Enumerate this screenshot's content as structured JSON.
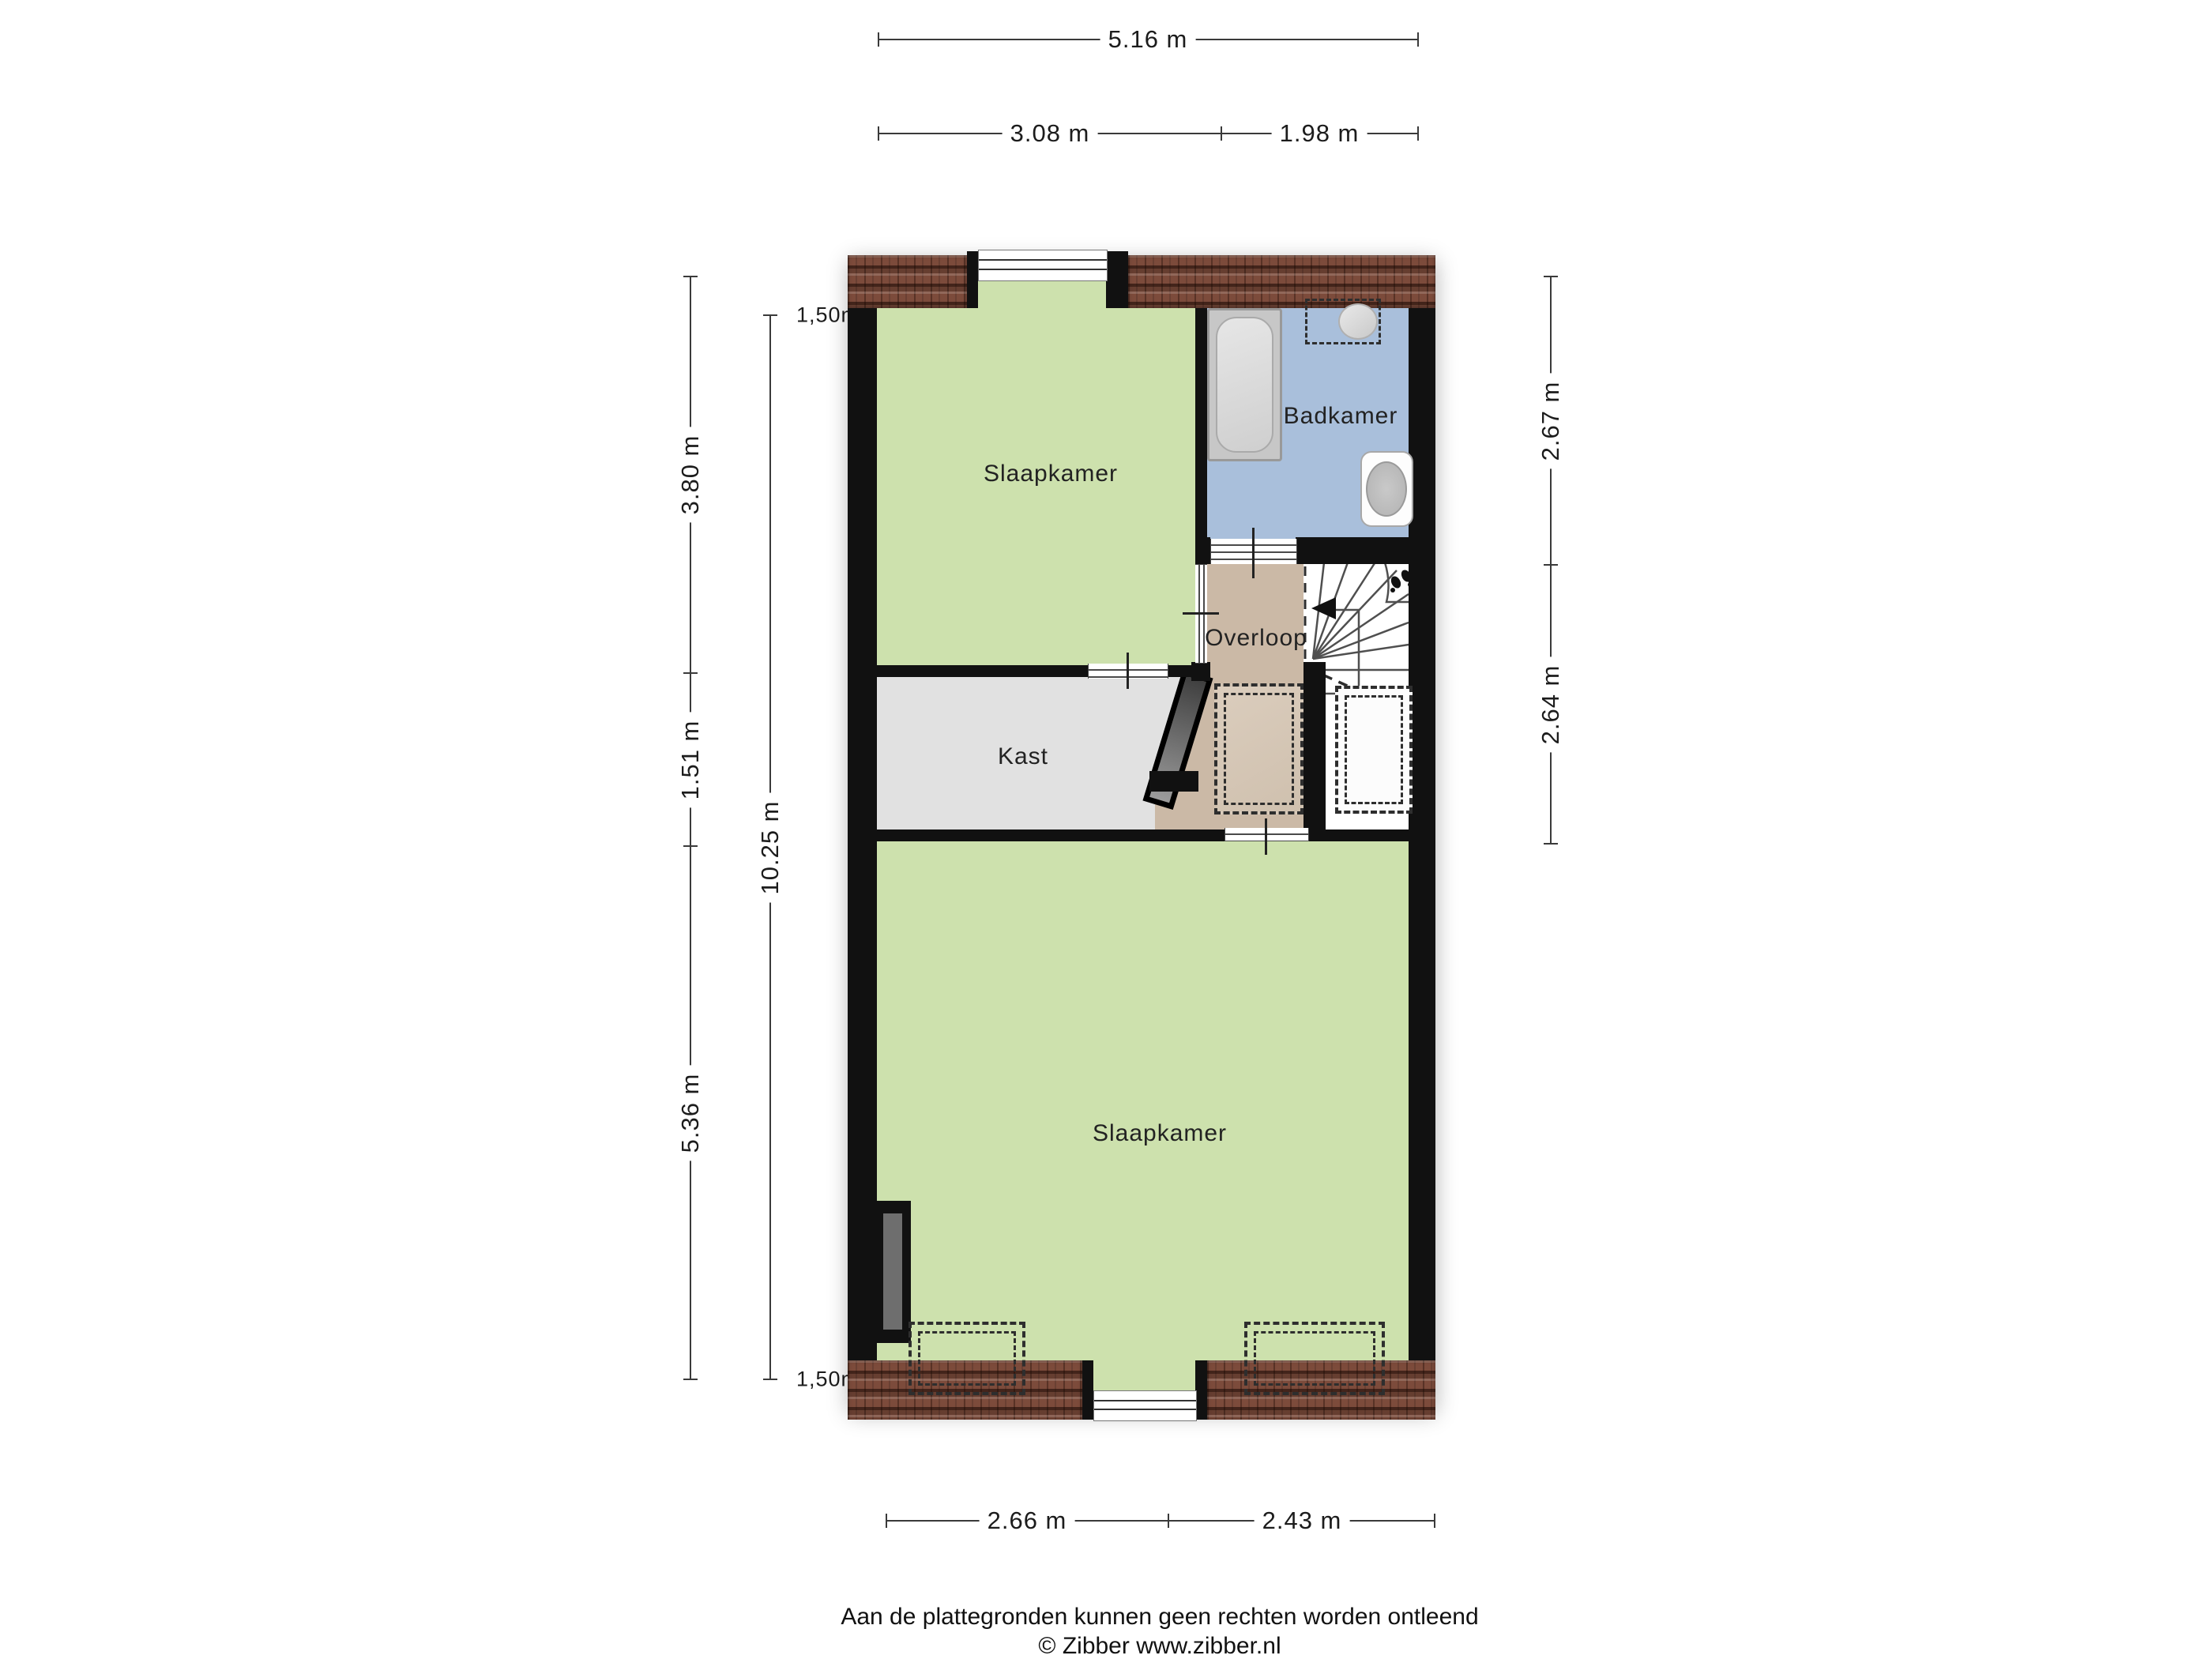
{
  "rooms": {
    "bedroom_top": "Slaapkamer",
    "bathroom": "Badkamer",
    "landing": "Overloop",
    "closet": "Kast",
    "bedroom_bottom": "Slaapkamer"
  },
  "dimensions": {
    "top_total": "5.16 m",
    "top_left": "3.08 m",
    "top_right": "1.98 m",
    "left_outer_top": "3.80 m",
    "left_outer_mid": "1.51 m",
    "left_outer_bottom": "5.36 m",
    "left_inner_total": "10.25 m",
    "left_inner_top_marker": "1,50m",
    "left_inner_bottom_marker": "1,50m",
    "right_top": "2.67 m",
    "right_bottom": "2.64 m",
    "bottom_left": "2.66 m",
    "bottom_right": "2.43 m"
  },
  "footer": {
    "disclaimer": "Aan de plattegronden kunnen geen rechten worden ontleend",
    "copyright": "© Zibber www.zibber.nl"
  },
  "colors": {
    "floor_green": "#cde1ad",
    "bathroom_blue": "#a9bfdb",
    "landing_tan": "#cbb9a6",
    "landing_tan_light": "#dbcdbd",
    "closet_grey": "#e1e1e1",
    "wall_black": "#111111",
    "roof_brown": "#7c4b3b",
    "fixture_grey": "#d9d9d9"
  },
  "icons": {
    "stairs_direction": "footsteps-icon",
    "stairs_arrow": "arrow-left-icon"
  }
}
